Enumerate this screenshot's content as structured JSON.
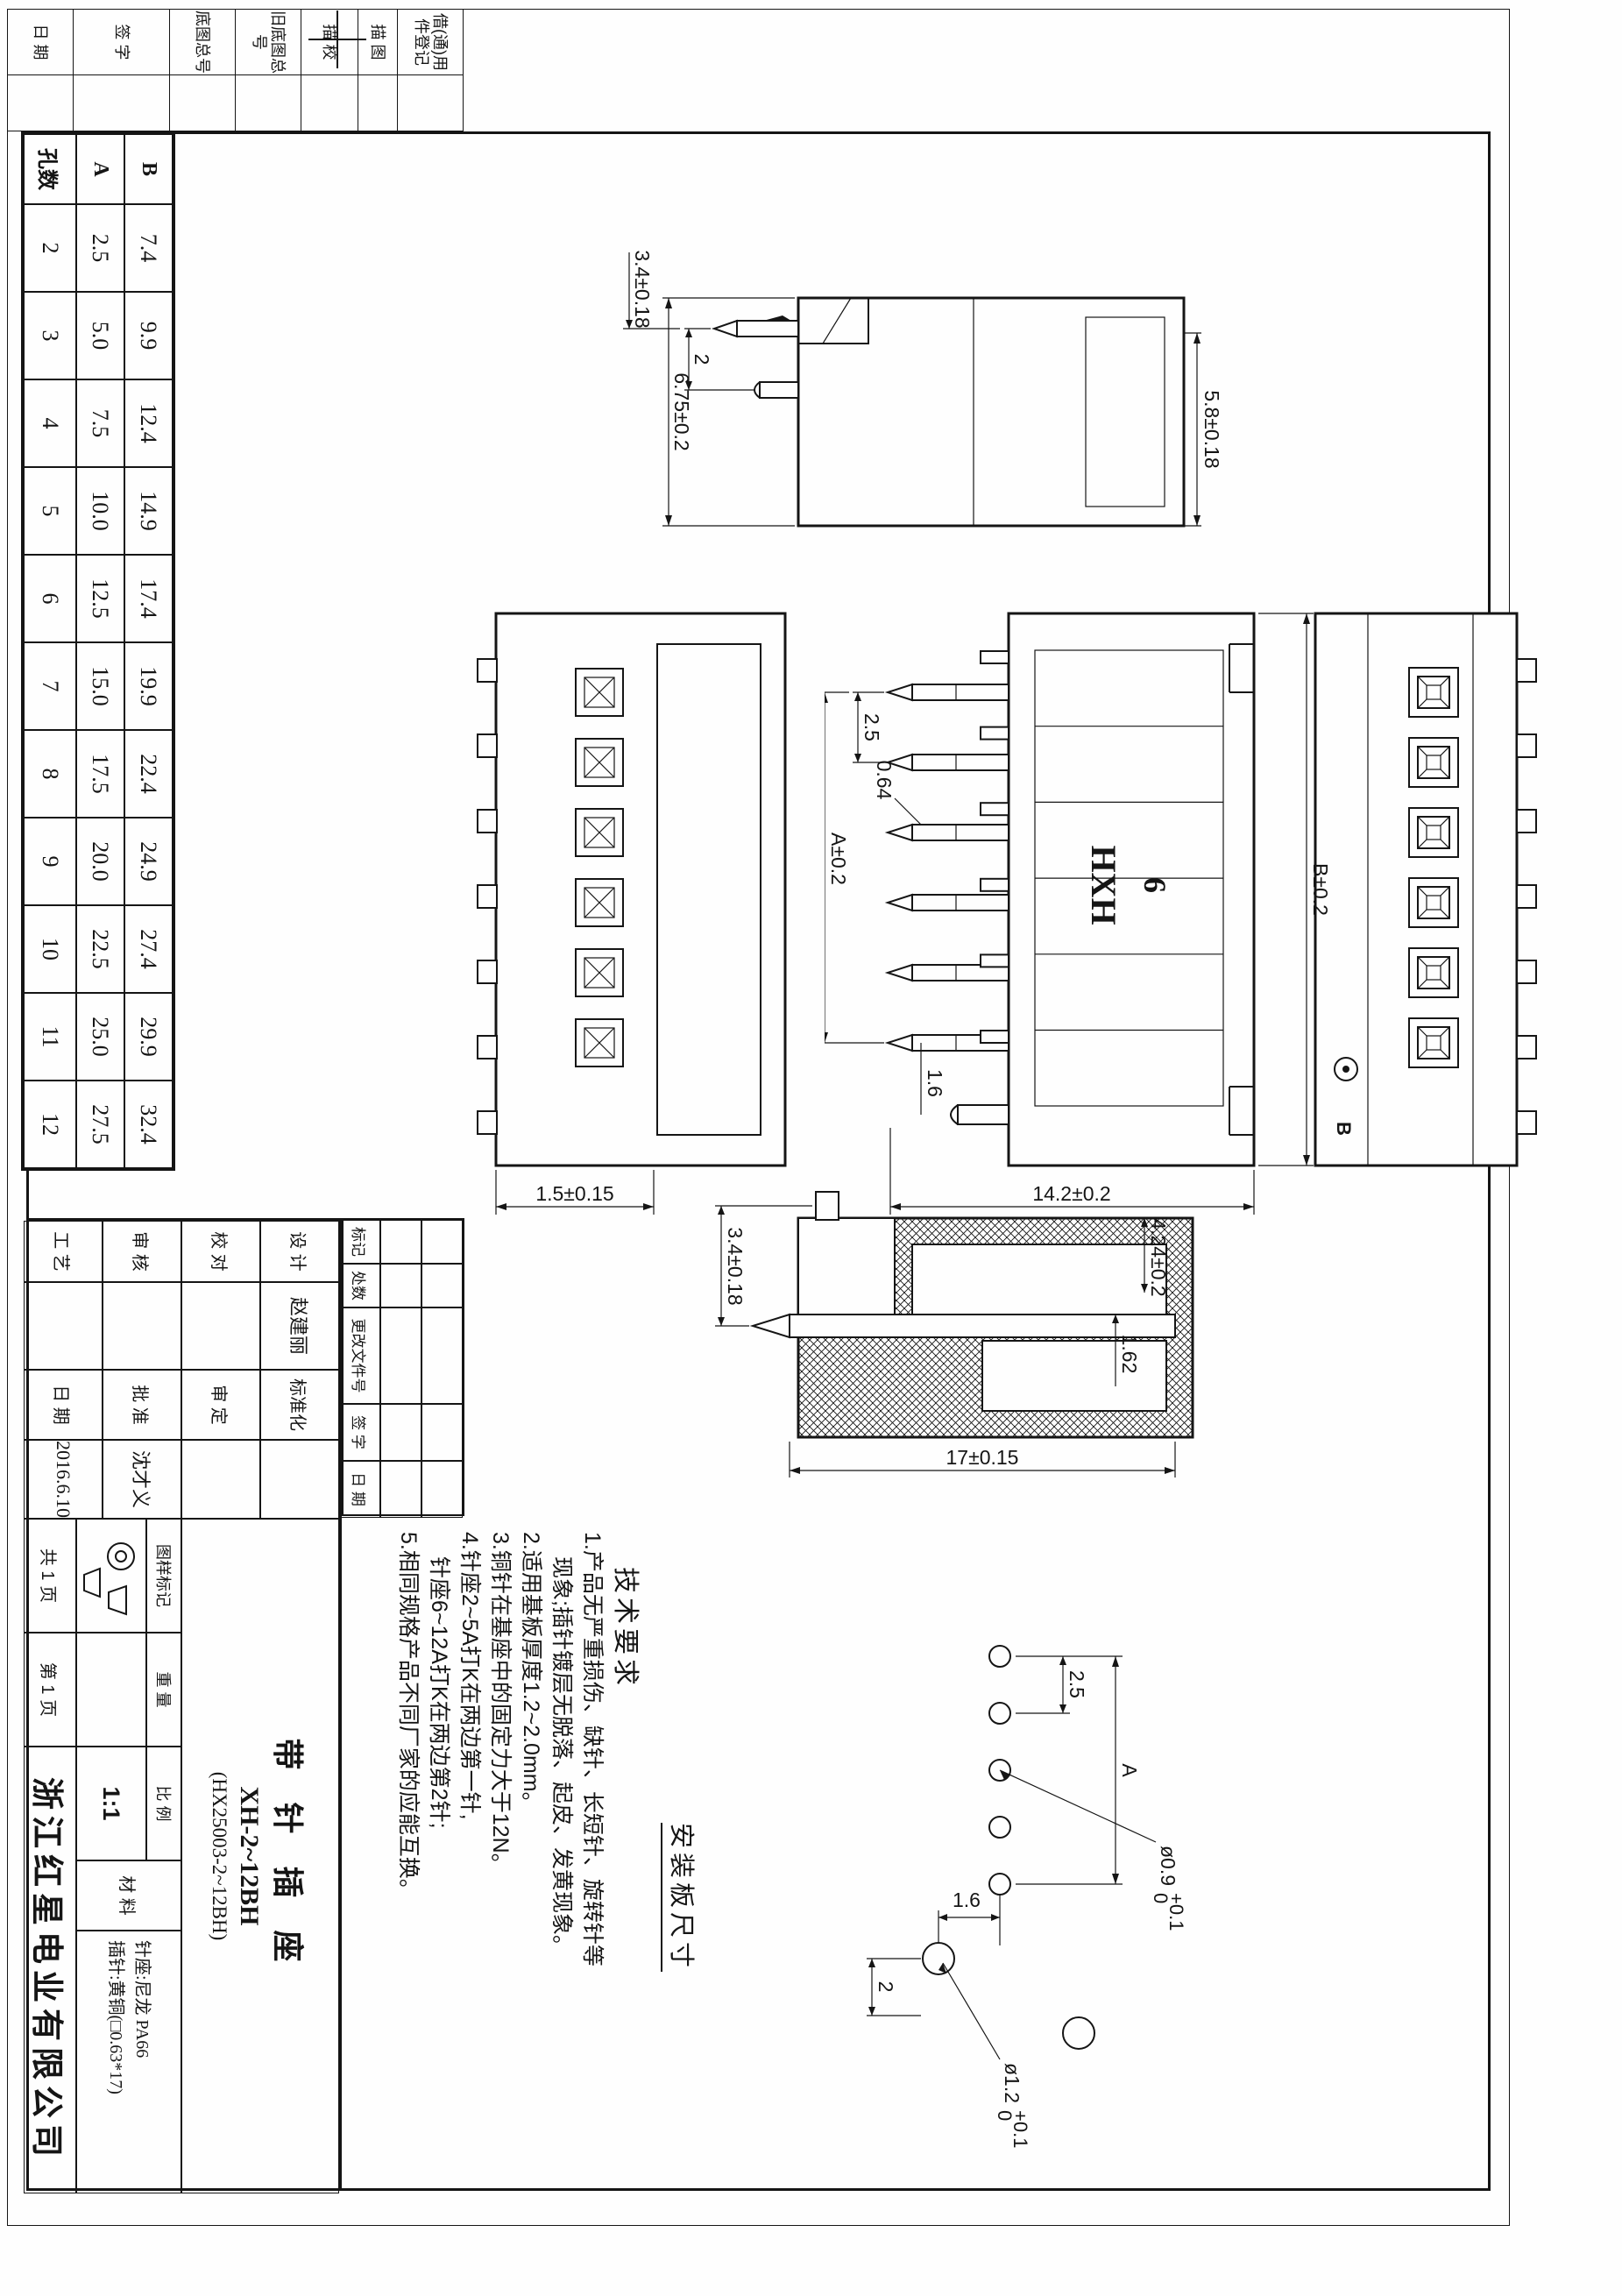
{
  "margin_strip": {
    "labels": [
      "借(通)用件登记",
      "描 图",
      "描 校",
      "旧底图总号",
      "底图总号",
      "签 字",
      "日 期"
    ]
  },
  "pin_table": {
    "row_headers": {
      "count": "孔数",
      "a": "A",
      "b": "B"
    },
    "columns": [
      {
        "count": "2",
        "a": "2.5",
        "b": "7.4"
      },
      {
        "count": "3",
        "a": "5.0",
        "b": "9.9"
      },
      {
        "count": "4",
        "a": "7.5",
        "b": "12.4"
      },
      {
        "count": "5",
        "a": "10.0",
        "b": "14.9"
      },
      {
        "count": "6",
        "a": "12.5",
        "b": "17.4"
      },
      {
        "count": "7",
        "a": "15.0",
        "b": "19.9"
      },
      {
        "count": "8",
        "a": "17.5",
        "b": "22.4"
      },
      {
        "count": "9",
        "a": "20.0",
        "b": "24.9"
      },
      {
        "count": "10",
        "a": "22.5",
        "b": "27.4"
      },
      {
        "count": "11",
        "a": "25.0",
        "b": "29.9"
      },
      {
        "count": "12",
        "a": "27.5",
        "b": "32.4"
      }
    ]
  },
  "side_view": {
    "dims": {
      "slot": "5.8±0.18",
      "height": "6.75±0.2",
      "pin_gap": "2",
      "pin_offset": "3.4±0.18"
    }
  },
  "front_view": {
    "brand": "HXH",
    "positions": "6",
    "dims": {
      "length": "B±0.2",
      "pitch": "2.5",
      "span": "A±0.2",
      "pin_w": "0.64",
      "end": "1.6",
      "height": "14.2±0.2",
      "peg": "1.5±0.15"
    }
  },
  "back_view": {
    "label": "B"
  },
  "section_view": {
    "dims": {
      "depth": "4.24±0.2",
      "lip": "1.62",
      "length": "17±0.15",
      "pin_out": "3.4±0.18"
    }
  },
  "install_panel": {
    "title": "安装板尺寸",
    "dims": {
      "pitch": "2.5",
      "span": "A",
      "offset_y": "1.6",
      "offset_x": "2"
    },
    "hole_small": {
      "dia": "ø0.9",
      "tol_up": "+0.1",
      "tol_dn": "0"
    },
    "hole_big": {
      "dia": "ø1.2",
      "tol_up": "+0.1",
      "tol_dn": "0"
    }
  },
  "tech_req": {
    "title": "技术要求",
    "lines": [
      "1.产品无严重损伤、缺针、长短针、旋转针等",
      "现象;插针镀层无脱落、起皮、发黄现象。",
      "2.适用基板厚度1.2~2.0mm。",
      "3.铜针在基座中的固定力大于12N。",
      "4.针座2~5A打K在两边第一针,",
      "针座6~12A打K在两边第2针;",
      "5.相同规格产品不同厂家的应能互换。"
    ]
  },
  "revision_table": {
    "headers": [
      "标记",
      "处数",
      "更改文件号",
      "签 字",
      "日 期"
    ]
  },
  "title_block": {
    "sig": {
      "design_label": "设 计",
      "design_name": "赵建丽",
      "check_label": "校 对",
      "review_label": "审 核",
      "process_label": "工 艺",
      "std_label": "标准化",
      "approve2_label": "审 定",
      "approve_label": "批 准",
      "approve_name": "沈才义",
      "date_label": "日 期",
      "date_value": "2016.6.10"
    },
    "product": {
      "name": "带 针 插 座",
      "model": "XH-2~12BH",
      "code": "(HX25003-2~12BH)"
    },
    "pages": {
      "total": "共 1 页",
      "page": "第 1 页"
    },
    "marks": {
      "mark_label": "图样标记",
      "weight_label": "重 量",
      "scale_label": "比 例",
      "scale_value": "1:1"
    },
    "material": {
      "label": "材 料",
      "line1": "针座:尼龙 PA66",
      "line2": "插针:黄铜(□0.63*17)"
    },
    "company": "浙江红星电业有限公司"
  }
}
